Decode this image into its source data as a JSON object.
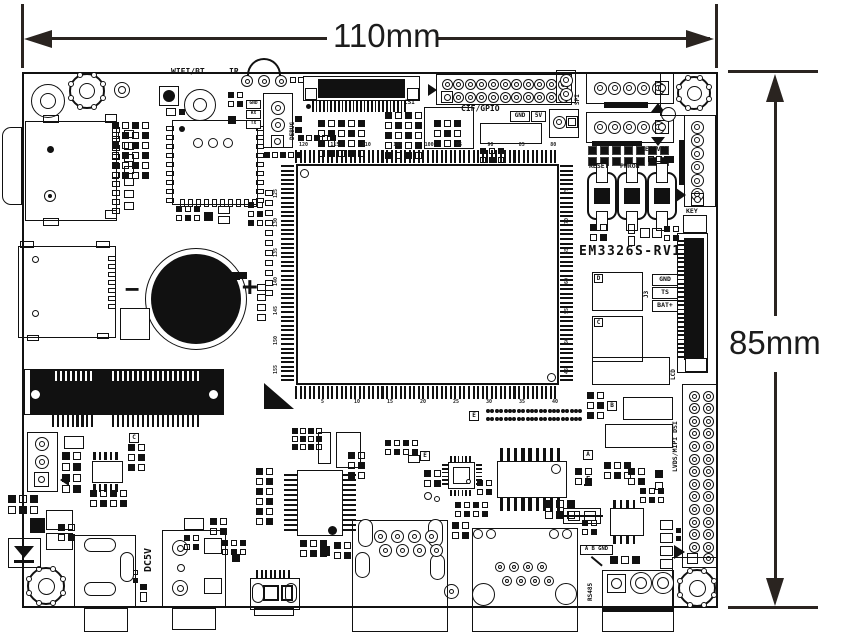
{
  "diagram": {
    "type": "pcb-dimension-drawing",
    "board_model": "EM3326S-RV1",
    "width_label": "110mm",
    "height_label": "85mm"
  },
  "labels": {
    "wifi_bt": "WIFI/BT",
    "ir": "IR",
    "debug": "DEBUG",
    "csi": "CSI",
    "cif_gpio": "CIF/GPIO",
    "gnd_box": "GND",
    "v5_box": "5V",
    "spi": "SPI",
    "reset": "RESET",
    "pwron": "PWRON",
    "recover": "RECOVER",
    "key": "KEY",
    "model": "EM3326S-RV1",
    "j3": "J3",
    "j3_pins": [
      "GND",
      "TS",
      "BAT+"
    ],
    "lcd": "LCD",
    "lvds": "LVDS/MIPI DSI",
    "dc5v": "DC5V",
    "rs485": "RS485",
    "rs485_pins": "A B GND",
    "uart_pins": [
      "GND",
      "RX",
      "TX"
    ],
    "battery_minus": "−",
    "battery_plus": "+",
    "ref_marks": [
      "A",
      "B",
      "C",
      "C",
      "D",
      "E",
      "E",
      "F"
    ]
  },
  "cpu": {
    "pins_top": [
      120,
      115,
      110,
      105,
      100,
      95,
      90,
      85,
      80
    ],
    "pins_bottom": [
      5,
      10,
      15,
      20,
      25,
      30,
      35,
      40
    ],
    "pins_left": [
      125,
      130,
      135,
      140,
      145,
      150,
      155
    ],
    "pins_right": [
      75,
      70,
      65,
      60,
      55,
      50,
      45
    ]
  },
  "connector_pins": {
    "cif_gpio": 22,
    "spi": 6,
    "key": 7,
    "debug": 3,
    "lvds_rows": 14,
    "rs485": 3
  }
}
